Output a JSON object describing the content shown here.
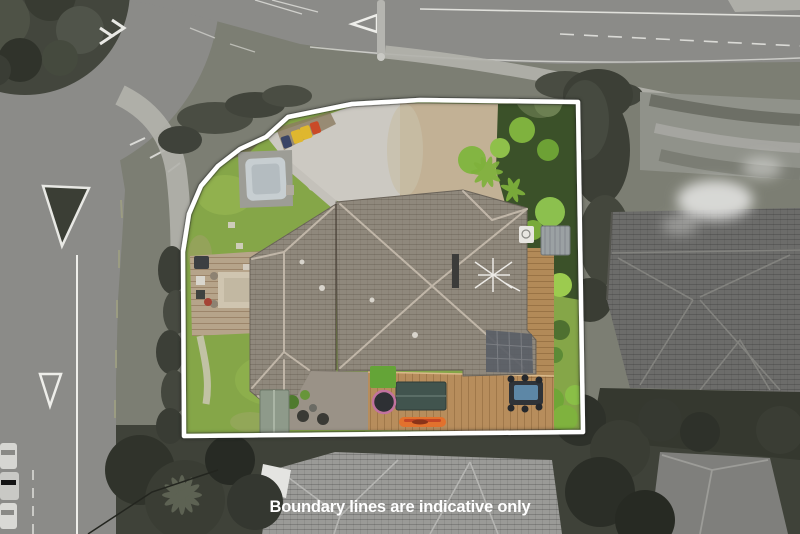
{
  "caption": {
    "text": "Boundary lines are indicative only",
    "color": "#ffffff"
  },
  "boundary": {
    "color": "#ffffff",
    "stroke_width": "4.5",
    "points": "184,436 183,252 189,214 201,186 218,166 240,149 266,137 288,117 352,104 420,100 578,102 583,432"
  },
  "palette": {
    "road": "#8b8b88",
    "verge": "#7c7e73",
    "footpath": "#b2b2ac",
    "island_green": "#43463d",
    "tree_gray": "#3c3f36",
    "neighbor_roof_right": "#6c6c6a",
    "neighbor_roof_bottom": "#9a9a97",
    "neighbor_roof_bottom_right": "#7f7f7c",
    "lawn": "#85a648",
    "driveway": "#ccc9c2",
    "dirt": "#c2b195",
    "house_roof": "#8f887c",
    "deck_wood": "#b28a58",
    "hedge": "#3b5129",
    "spa": "#c7ced1",
    "shed_green": "#8e9a8a",
    "shed_teal": "#41544e",
    "kayak": "#e2712d",
    "bin_dark": "#3a4466",
    "bin_yellow": "#dfb72e",
    "bin_red": "#c94a28",
    "solar": "#5a5e66",
    "table_top": "#5d87a6"
  }
}
